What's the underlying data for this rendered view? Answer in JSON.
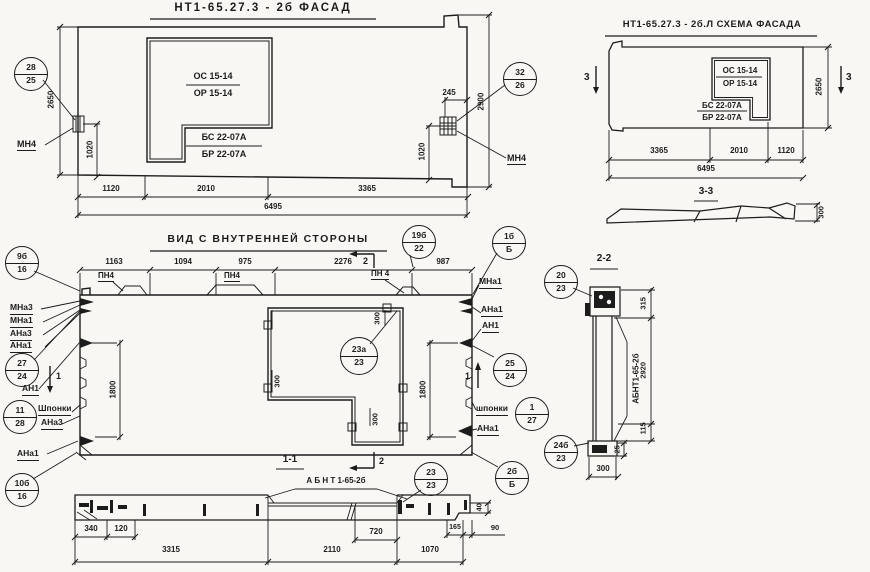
{
  "colors": {
    "paper": "#f8f7f4",
    "ink": "#1c1c1c"
  },
  "titles": {
    "facade": "НТ1-65.27.3 - 2б ФАСАД",
    "schema": "НТ1-65.27.3 - 2б.Л СХЕМА ФАСАДА",
    "inner": "ВИД С ВНУТРЕННЕЙ СТОРОНЫ",
    "s11": "1-1",
    "s22": "2-2",
    "s33": "3-3",
    "s11_label": "А Б Н Т 1-65-2б",
    "s22_label": "АБНТ1-65-2б"
  },
  "win": {
    "os": "ОС 15-14",
    "or": "ОР 15-14",
    "bs": "БС 22-07А",
    "br": "БР 22-07А"
  },
  "labels": {
    "mn4": "МН4",
    "mna3": "МНа3",
    "mna1": "МНа1",
    "ana3": "АНа3",
    "ana1": "АНа1",
    "an1": "АН1",
    "pn4": "ПН4",
    "pn4sp": "ПН 4",
    "shponki": "Шпонки",
    "shponki_lc": "шпонки"
  },
  "markers": {
    "m1": "1",
    "m2": "2",
    "m3": "3"
  },
  "dims": {
    "d25": "25",
    "d40": "40",
    "d90": "90",
    "d115": "115",
    "d120": "120",
    "d165": "165",
    "d245": "245",
    "d300": "300",
    "d315": "315",
    "d340": "340",
    "d720": "720",
    "d975": "975",
    "d987": "987",
    "d1020": "1020",
    "d1070": "1070",
    "d1094": "1094",
    "d1120": "1120",
    "d1163": "1163",
    "d1800": "1800",
    "d2010": "2010",
    "d2110": "2110",
    "d2276": "2276",
    "d2650": "2650",
    "d2900": "2900",
    "d2920": "2920",
    "d3315": "3315",
    "d3365": "3365",
    "d6495": "6495"
  },
  "circles": [
    {
      "top": "28",
      "bottom": "25"
    },
    {
      "top": "32",
      "bottom": "26"
    },
    {
      "top": "9б",
      "bottom": "16"
    },
    {
      "top": "19б",
      "bottom": "22"
    },
    {
      "top": "1б",
      "bottom": "Б"
    },
    {
      "top": "27",
      "bottom": "24"
    },
    {
      "top": "11",
      "bottom": "28"
    },
    {
      "top": "10б",
      "bottom": "16"
    },
    {
      "top": "23а",
      "bottom": "23"
    },
    {
      "top": "25",
      "bottom": "24"
    },
    {
      "top": "1",
      "bottom": "27"
    },
    {
      "top": "2б",
      "bottom": "Б"
    },
    {
      "top": "23",
      "bottom": "23"
    },
    {
      "top": "20",
      "bottom": "23"
    },
    {
      "top": "24б",
      "bottom": "23"
    }
  ]
}
